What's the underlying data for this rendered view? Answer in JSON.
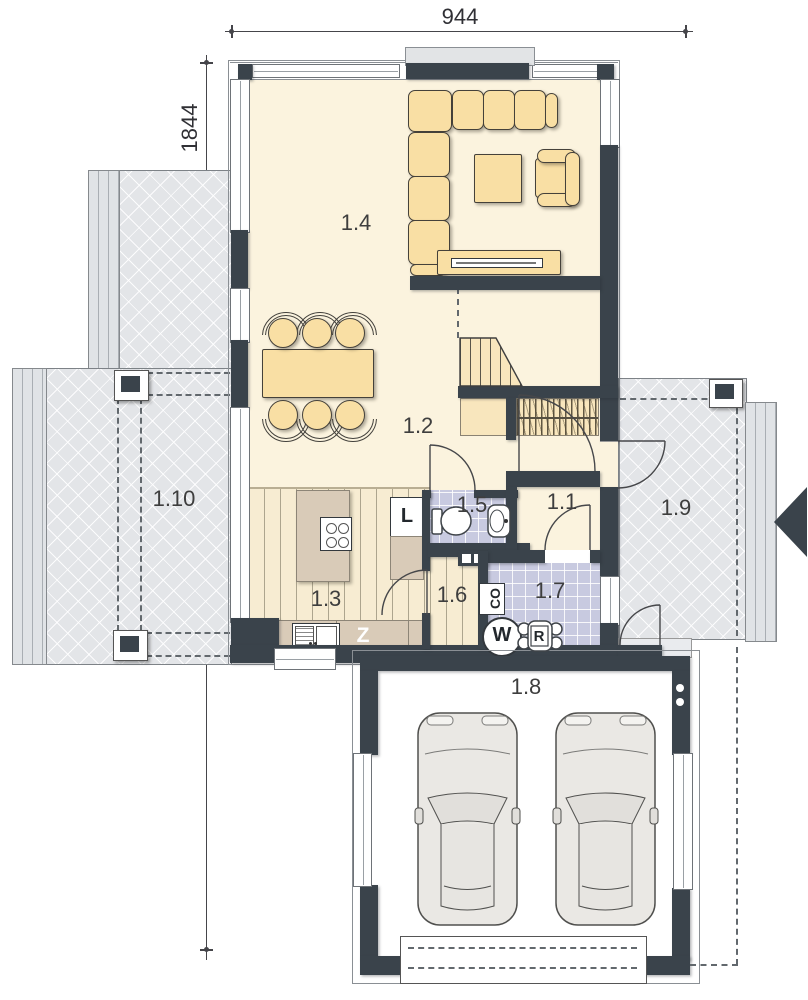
{
  "dimensions": {
    "top": "944",
    "left": "1844"
  },
  "rooms": {
    "r1_1": "1.1",
    "r1_2": "1.2",
    "r1_3": "1.3",
    "r1_4": "1.4",
    "r1_5": "1.5",
    "r1_6": "1.6",
    "r1_7": "1.7",
    "r1_8": "1.8",
    "r1_9": "1.9",
    "r1_10": "1.10"
  },
  "appliances": {
    "fridge": "L",
    "dishwasher": "Z",
    "heating_boiler": "CO",
    "washing_machine": "W",
    "recuperator": "R"
  },
  "colors": {
    "wall": "#3a434b",
    "floor_cream": "#fbf3de",
    "furniture_tan": "#f9dfa4",
    "counter": "#d9cbb8",
    "tile": "#c8cae0",
    "wood": "#f7ecd2",
    "terrace": "#e3e5e8"
  }
}
